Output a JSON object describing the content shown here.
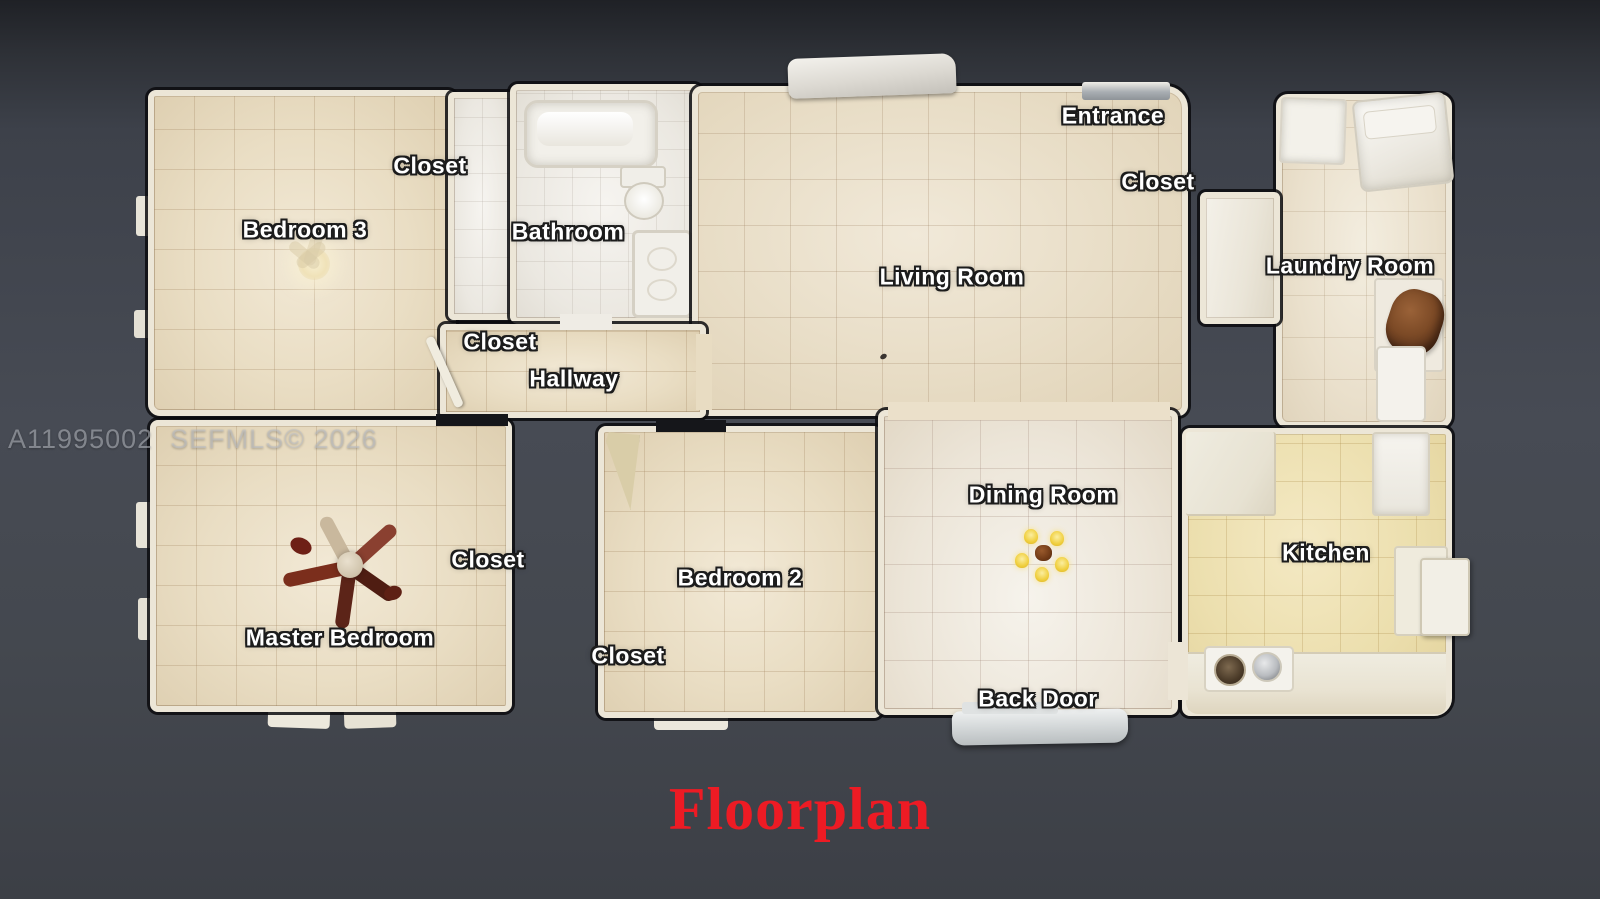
{
  "title": "Floorplan",
  "watermark": "A11995002  SEFMLS© 2026",
  "rooms": {
    "bedroom3": "Bedroom 3",
    "bedroom3_closet": "Closet",
    "bathroom": "Bathroom",
    "hall_closet": "Closet",
    "hallway": "Hallway",
    "living_room": "Living Room",
    "entrance": "Entrance",
    "entrance_closet": "Closet",
    "laundry_room": "Laundry Room",
    "master_bedroom": "Master Bedroom",
    "master_closet": "Closet",
    "bedroom2": "Bedroom 2",
    "bedroom2_closet": "Closet",
    "dining_room": "Dining Room",
    "kitchen": "Kitchen",
    "back_door": "Back Door"
  },
  "furniture_visible": [
    "bathtub",
    "toilet",
    "bathroom-vanity",
    "ceiling-fan-bedroom3",
    "ceiling-fan-master",
    "dining-chandelier",
    "kitchen-counter",
    "kitchen-sink",
    "refrigerator",
    "washer-dryer",
    "laundry-shelf-clutter",
    "entrance-porch",
    "back-door-step"
  ],
  "colors": {
    "background": "#42464e",
    "title_red": "#ed1b24",
    "floor_beige": "#e9ddc3",
    "floor_white": "#f0ede6",
    "kitchen_yellow": "#ecdfae",
    "wall": "#ece6d7",
    "label_text": "#ffffff",
    "label_outline": "#1c1c1c",
    "watermark_gray": "#bec1c8"
  }
}
